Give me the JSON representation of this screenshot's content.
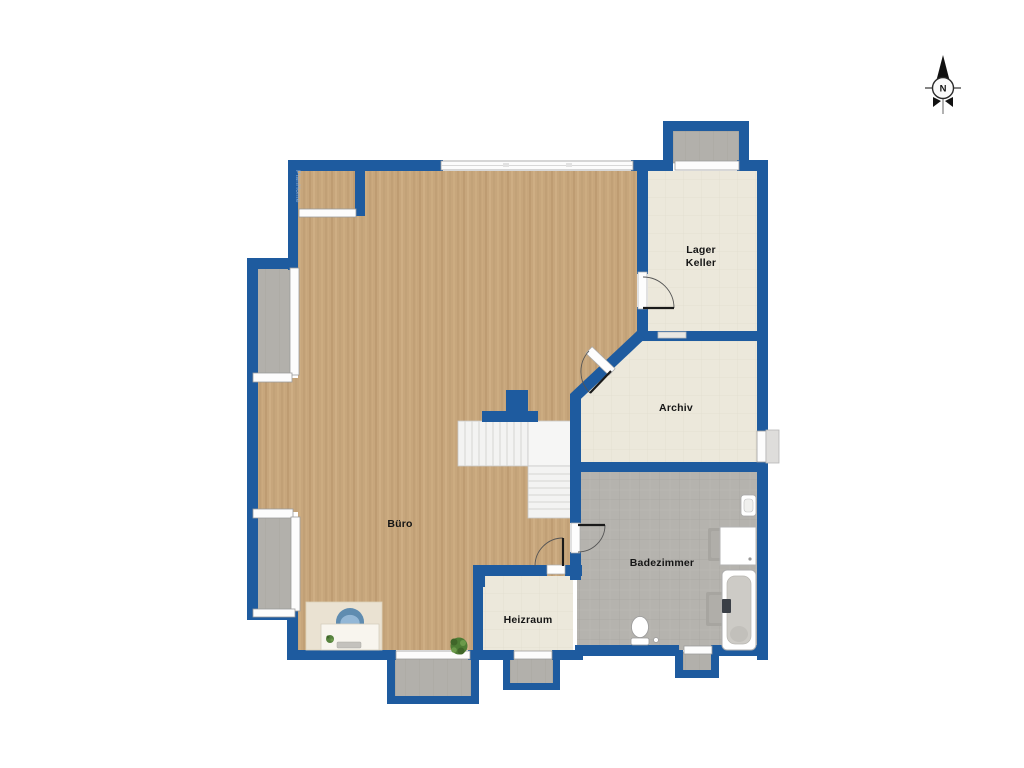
{
  "plan": {
    "watermark": "PlanHome",
    "compass": {
      "north_label": "N"
    },
    "rooms": {
      "buero": {
        "label": "Büro"
      },
      "lager_keller": {
        "label_line1": "Lager",
        "label_line2": "Keller"
      },
      "archiv": {
        "label": "Archiv"
      },
      "badezimmer": {
        "label": "Badezimmer"
      },
      "heizraum": {
        "label": "Heizraum"
      }
    },
    "colors": {
      "wall": "#1e5b9f",
      "wood_floor": "#c7a67c",
      "cream_floor": "#ece8db",
      "tile_floor": "#b5b3ae",
      "exterior_gray": "#b2b0ab",
      "window_white": "#fcfcfc",
      "background": "#ffffff"
    }
  }
}
